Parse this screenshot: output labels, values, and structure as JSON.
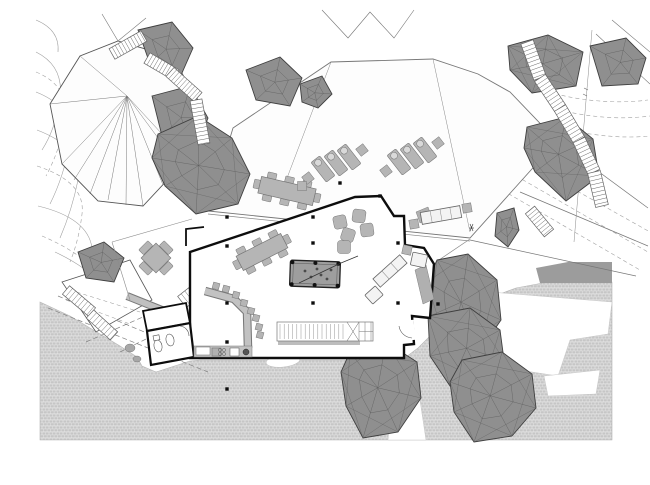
{
  "meta": {
    "drawing_type": "architectural-site-plan",
    "canvas": {
      "width": 650,
      "height": 485,
      "background": "#ffffff"
    }
  },
  "palette": {
    "rockFill": "#8f8f8f",
    "rockEdge": "#3f3f3f",
    "rockMesh": "#565656",
    "furn": "#b5b5b5",
    "furnEdge": "#787878",
    "furnLight": "#f3f3f3",
    "wall": "#0d0d0d",
    "line": "#666666",
    "thin": "#8c8c8c",
    "contour": "#a0a0a0",
    "pavingBg": "#e2e2e2",
    "pavingBrick": "#c6c6c6",
    "pavingDark": "#9c9c9c",
    "pool": "#9e9e9e",
    "white": "#ffffff",
    "offwhite": "#fdfdfd"
  },
  "contours": {
    "solid": [
      "M36,52 Q64,66 60,98 Q56,128 42,150",
      "M36,92 Q76,108 70,142 Q64,176 50,204",
      "M37,130 Q84,148 78,180 Q72,210 60,238",
      "M38,206 Q88,218 92,248 Q95,268 108,284",
      "M55,252 Q85,266 104,286",
      "M36,20 Q60,30 58,52"
    ],
    "dashed": [
      "M36,72 Q70,86 65,120 Q60,150 46,176",
      "M37,166 Q86,182 82,214 Q79,240 70,262",
      "M42,236 Q80,252 98,274",
      "M548,92 Q600,106 648,100",
      "M552,108 Q604,122 650,116",
      "M384,128 Q410,118 434,128",
      "M560,128 Q610,140 650,136",
      "M492,162 L648,252",
      "M504,150 L650,232",
      "M478,176 L640,270"
    ]
  },
  "paving": {
    "main": [
      [
        40,
        302
      ],
      [
        70,
        316
      ],
      [
        120,
        346
      ],
      [
        137,
        357
      ],
      [
        142,
        366
      ],
      [
        156,
        372
      ],
      [
        190,
        361
      ],
      [
        200,
        360
      ],
      [
        336,
        360
      ],
      [
        402,
        360
      ],
      [
        418,
        348
      ],
      [
        436,
        330
      ],
      [
        458,
        314
      ],
      [
        484,
        300
      ],
      [
        516,
        288
      ],
      [
        548,
        282
      ],
      [
        612,
        282
      ],
      [
        612,
        440
      ],
      [
        40,
        440
      ]
    ],
    "cutouts": [
      [
        [
          490,
          292
        ],
        [
          612,
          302
        ],
        [
          608,
          334
        ],
        [
          570,
          340
        ],
        [
          558,
          376
        ],
        [
          506,
          368
        ],
        [
          480,
          328
        ]
      ],
      [
        [
          544,
          376
        ],
        [
          600,
          370
        ],
        [
          596,
          394
        ],
        [
          548,
          396
        ]
      ],
      [
        [
          396,
          362
        ],
        [
          414,
          361
        ],
        [
          426,
          440
        ],
        [
          388,
          440
        ]
      ]
    ],
    "blob": {
      "cx": 283,
      "cy": 361,
      "rx": 17,
      "ry": 6,
      "rot": -6
    },
    "darkBand": [
      [
        536,
        268
      ],
      [
        568,
        262
      ],
      [
        612,
        262
      ],
      [
        612,
        283
      ],
      [
        540,
        283
      ]
    ],
    "dashedDiagonals": [
      "M48,308 L208,372",
      "M58,296 L202,356",
      "M86,342 L168,306",
      "M120,352 L180,322"
    ]
  },
  "terrace": {
    "platform": [
      [
        62,
        282
      ],
      [
        130,
        260
      ],
      [
        152,
        300
      ],
      [
        96,
        332
      ]
    ],
    "dashed": [
      "M70,290 L140,312",
      "M66,300 L130,324"
    ],
    "grayBand": "M127,296 L182,318",
    "blobs": [
      [
        130,
        348,
        5,
        4
      ],
      [
        137,
        359,
        4,
        3
      ]
    ]
  },
  "tent": {
    "outline": [
      [
        50,
        104
      ],
      [
        80,
        56
      ],
      [
        118,
        41
      ],
      [
        173,
        57
      ],
      [
        199,
        104
      ],
      [
        186,
        160
      ],
      [
        143,
        206
      ],
      [
        98,
        201
      ],
      [
        62,
        164
      ]
    ],
    "apex": [
      127,
      96
    ],
    "rayTargets": [
      [
        62,
        164
      ],
      [
        74,
        180
      ],
      [
        90,
        194
      ],
      [
        108,
        200
      ],
      [
        126,
        205
      ],
      [
        143,
        206
      ],
      [
        163,
        185
      ],
      [
        178,
        165
      ],
      [
        186,
        160
      ],
      [
        50,
        104
      ],
      [
        80,
        56
      ]
    ],
    "extraLines": [
      "M118,41 L102,14",
      "M118,41 L146,18",
      "M322,10 L348,38 L370,12 L394,38 L414,10",
      "M612,20 L650,52",
      "M596,34 L650,84"
    ]
  },
  "roof": {
    "outline": [
      [
        233,
        128
      ],
      [
        331,
        62
      ],
      [
        433,
        59
      ],
      [
        478,
        74
      ],
      [
        510,
        92
      ],
      [
        557,
        141
      ],
      [
        470,
        238
      ],
      [
        208,
        211
      ]
    ],
    "folds": [
      "M433,59 L470,232",
      "M331,62 L284,186"
    ],
    "edgeDouble": [
      "M208,214 L470,241",
      "M470,239 L436,262"
    ]
  },
  "walkway": {
    "lines": [
      "M557,141 L648,208",
      "M470,240 L636,276",
      "M520,192 L648,246"
    ],
    "propertyLine": "M592,30 L574,242",
    "ticks": [
      "M584,88 L588,90",
      "M583,94 L587,96"
    ]
  },
  "rocks": [
    {
      "name": "rock-nw-1",
      "pts": [
        [
          138,
          30
        ],
        [
          172,
          22
        ],
        [
          193,
          48
        ],
        [
          178,
          82
        ],
        [
          150,
          64
        ]
      ]
    },
    {
      "name": "rock-nw-2",
      "pts": [
        [
          152,
          96
        ],
        [
          190,
          86
        ],
        [
          208,
          118
        ],
        [
          194,
          152
        ],
        [
          162,
          136
        ]
      ]
    },
    {
      "name": "rock-nw-3",
      "pts": [
        [
          158,
          134
        ],
        [
          198,
          116
        ],
        [
          232,
          138
        ],
        [
          250,
          174
        ],
        [
          238,
          204
        ],
        [
          196,
          214
        ],
        [
          165,
          186
        ],
        [
          152,
          158
        ]
      ]
    },
    {
      "name": "rock-w",
      "pts": [
        [
          78,
          252
        ],
        [
          104,
          242
        ],
        [
          124,
          258
        ],
        [
          114,
          282
        ],
        [
          86,
          278
        ]
      ]
    },
    {
      "name": "rock-n-1",
      "pts": [
        [
          246,
          70
        ],
        [
          280,
          57
        ],
        [
          302,
          78
        ],
        [
          290,
          106
        ],
        [
          256,
          100
        ]
      ]
    },
    {
      "name": "rock-n-2",
      "pts": [
        [
          300,
          84
        ],
        [
          322,
          76
        ],
        [
          332,
          94
        ],
        [
          318,
          108
        ],
        [
          302,
          102
        ]
      ]
    },
    {
      "name": "rock-ne-1",
      "pts": [
        [
          508,
          46
        ],
        [
          548,
          35
        ],
        [
          583,
          52
        ],
        [
          576,
          86
        ],
        [
          532,
          93
        ],
        [
          510,
          70
        ]
      ]
    },
    {
      "name": "rock-ne-2",
      "pts": [
        [
          590,
          46
        ],
        [
          626,
          38
        ],
        [
          646,
          58
        ],
        [
          638,
          84
        ],
        [
          602,
          86
        ]
      ]
    },
    {
      "name": "rock-ne-3",
      "pts": [
        [
          527,
          127
        ],
        [
          566,
          117
        ],
        [
          593,
          139
        ],
        [
          599,
          176
        ],
        [
          566,
          201
        ],
        [
          535,
          172
        ],
        [
          524,
          148
        ]
      ]
    },
    {
      "name": "rock-e",
      "pts": [
        [
          497,
          213
        ],
        [
          514,
          208
        ],
        [
          519,
          230
        ],
        [
          508,
          247
        ],
        [
          495,
          236
        ]
      ]
    },
    {
      "name": "rock-se-upper",
      "pts": [
        [
          437,
          260
        ],
        [
          468,
          254
        ],
        [
          497,
          280
        ],
        [
          501,
          320
        ],
        [
          479,
          352
        ],
        [
          449,
          354
        ],
        [
          430,
          316
        ],
        [
          427,
          282
        ]
      ]
    },
    {
      "name": "rock-se-mid",
      "pts": [
        [
          428,
          316
        ],
        [
          470,
          308
        ],
        [
          500,
          330
        ],
        [
          504,
          360
        ],
        [
          484,
          382
        ],
        [
          450,
          386
        ],
        [
          430,
          356
        ]
      ]
    },
    {
      "name": "rock-se-lower",
      "pts": [
        [
          462,
          360
        ],
        [
          502,
          352
        ],
        [
          532,
          374
        ],
        [
          536,
          408
        ],
        [
          512,
          436
        ],
        [
          474,
          442
        ],
        [
          454,
          412
        ],
        [
          450,
          382
        ]
      ]
    },
    {
      "name": "rock-s",
      "pts": [
        [
          350,
          352
        ],
        [
          386,
          342
        ],
        [
          417,
          362
        ],
        [
          421,
          398
        ],
        [
          398,
          432
        ],
        [
          363,
          438
        ],
        [
          346,
          406
        ],
        [
          341,
          372
        ]
      ]
    }
  ],
  "stairs": [
    {
      "name": "stair-nw-1",
      "a": [
        112,
        54
      ],
      "b": [
        144,
        36
      ],
      "w": 12,
      "s": 3.5
    },
    {
      "name": "stair-nw-2",
      "a": [
        147,
        58
      ],
      "b": [
        176,
        75
      ],
      "w": 12,
      "s": 3.5
    },
    {
      "name": "stair-nw-3",
      "a": [
        170,
        72
      ],
      "b": [
        198,
        97
      ],
      "w": 12,
      "s": 3.5
    },
    {
      "name": "stair-nw-4",
      "a": [
        196,
        100
      ],
      "b": [
        204,
        144
      ],
      "w": 12,
      "s": 4
    },
    {
      "name": "stair-ne-1",
      "a": [
        527,
        42
      ],
      "b": [
        540,
        78
      ],
      "w": 13,
      "s": 4
    },
    {
      "name": "stair-ne-2",
      "a": [
        540,
        78
      ],
      "b": [
        560,
        108
      ],
      "w": 13,
      "s": 4
    },
    {
      "name": "stair-ne-3",
      "a": [
        560,
        108
      ],
      "b": [
        579,
        140
      ],
      "w": 13,
      "s": 4
    },
    {
      "name": "stair-ne-4",
      "a": [
        579,
        140
      ],
      "b": [
        594,
        172
      ],
      "w": 13,
      "s": 4
    },
    {
      "name": "stair-ne-5",
      "a": [
        594,
        172
      ],
      "b": [
        602,
        206
      ],
      "w": 13,
      "s": 4
    },
    {
      "name": "stair-walkway",
      "a": [
        530,
        210
      ],
      "b": [
        549,
        233
      ],
      "w": 12,
      "s": 3.5
    },
    {
      "name": "stair-terrace-1",
      "a": [
        66,
        290
      ],
      "b": [
        92,
        312
      ],
      "w": 11,
      "s": 4
    },
    {
      "name": "stair-terrace-2",
      "a": [
        90,
        314
      ],
      "b": [
        114,
        336
      ],
      "w": 11,
      "s": 4
    },
    {
      "name": "stair-terrace-3",
      "a": [
        182,
        302
      ],
      "b": [
        210,
        280
      ],
      "w": 14,
      "s": 4.5
    }
  ],
  "building": {
    "wall": "M190,252 L310,212 L355,197 L381,196 L394,216 L404,216 L405,245 L424,248 L434,264 L430,318 L412,316 L414,344 L404,345 L404,358 L190,358 Z",
    "stubs": [
      "M186,246 L186,229 L204,227"
    ],
    "deckLines": [
      "M112,242 L192,219",
      "M112,242 L130,300"
    ],
    "wcUpper": [
      [
        143,
        311
      ],
      [
        186,
        303
      ],
      [
        190,
        323
      ],
      [
        147,
        331
      ]
    ],
    "wcLower": [
      [
        147,
        331
      ],
      [
        190,
        323
      ],
      [
        194,
        357
      ],
      [
        151,
        365
      ]
    ],
    "wcDoorArc": "M180,326 A10,10 0 0 1 189,336",
    "doorGap": {
      "x1": 411,
      "y1": 320,
      "x2": 413,
      "y2": 340
    },
    "doorArc": "M412,338 A14,14 0 0 1 399,326"
  },
  "furniture": {
    "tablesLong": [
      {
        "name": "dining-table-outdoor",
        "c": [
          287,
          191
        ],
        "w": 56,
        "h": 17,
        "angle": 13
      },
      {
        "name": "dining-table-indoor",
        "c": [
          262,
          252
        ],
        "w": 50,
        "h": 16,
        "angle": -27
      }
    ],
    "crossTable": {
      "c": [
        156,
        258
      ],
      "size": 21,
      "angle": 45
    },
    "poufs": [
      [
        340,
        222,
        -12
      ],
      [
        359,
        216,
        8
      ],
      [
        348,
        235,
        18
      ],
      [
        367,
        230,
        -8
      ],
      [
        344,
        247,
        0
      ]
    ],
    "loungerGroups": [
      {
        "angle": -38,
        "items": [
          [
            323,
            169
          ],
          [
            336,
            163
          ],
          [
            349,
            157
          ]
        ],
        "tables": [
          [
            308,
            178
          ],
          [
            362,
            150
          ]
        ]
      },
      {
        "angle": -38,
        "items": [
          [
            399,
            162
          ],
          [
            412,
            156
          ],
          [
            425,
            150
          ]
        ],
        "tables": [
          [
            386,
            171
          ],
          [
            438,
            143
          ]
        ]
      }
    ],
    "extraTables": [
      [
        302,
        186
      ]
    ],
    "poolTable": {
      "c": [
        315,
        274
      ],
      "w": 50,
      "h": 26,
      "angle": 2,
      "balls": [
        [
          305,
          271
        ],
        [
          311,
          277
        ],
        [
          317,
          269
        ],
        [
          321,
          275
        ],
        [
          327,
          279
        ],
        [
          331,
          270
        ]
      ],
      "cue": "M299,283 L341,263 L358,256"
    },
    "sofaLong": {
      "c": [
        441,
        215
      ],
      "len": 40,
      "dep": 12,
      "angle": -10,
      "seats": 4,
      "tables": [
        [
          414,
          224
        ],
        [
          467,
          208
        ]
      ]
    },
    "sofaAngled": {
      "c": [
        390,
        271
      ],
      "len": 36,
      "dep": 11,
      "angle": -42,
      "seats": 3
    },
    "armchairs": [
      {
        "c": [
          374,
          295
        ],
        "w": 14,
        "h": 12,
        "angle": -42
      },
      {
        "c": [
          419,
          260
        ],
        "w": 15,
        "h": 13,
        "angle": 12
      }
    ],
    "ottoman": {
      "c": [
        407,
        250
      ],
      "w": 9,
      "h": 9,
      "angle": 12
    },
    "grayQuads": [
      [
        [
          415,
          270
        ],
        [
          426,
          265
        ],
        [
          434,
          299
        ],
        [
          423,
          304
        ]
      ],
      [
        [
          416,
          212
        ],
        [
          428,
          207
        ],
        [
          432,
          218
        ],
        [
          420,
          223
        ]
      ]
    ],
    "bar": {
      "band": "M205,291 L234,299 L247,312 L248,348",
      "stools": [
        [
          216,
          286
        ],
        [
          226,
          289
        ],
        [
          236,
          295
        ],
        [
          244,
          303
        ],
        [
          251,
          311
        ],
        [
          256,
          318
        ],
        [
          259,
          327
        ],
        [
          260,
          335
        ]
      ],
      "stoolSize": 6.5
    },
    "counter": {
      "x": 194,
      "y": 346,
      "w": 58,
      "h": 11,
      "box1": [
        196,
        347,
        14,
        8
      ],
      "box2": [
        212,
        348,
        9,
        8
      ],
      "burners": [
        [
          220,
          350
        ],
        [
          224,
          350
        ],
        [
          220,
          354
        ],
        [
          224,
          354
        ]
      ],
      "sink": [
        230,
        348,
        9,
        8
      ],
      "circle": [
        246,
        352,
        3
      ]
    },
    "shelfStair": {
      "x": 277,
      "y": 322,
      "w": 96,
      "h": 19,
      "step": 4.2,
      "xCell": [
        347,
        359
      ],
      "gridCols": [
        359,
        365,
        371
      ],
      "shadow": [
        278,
        341,
        82,
        4
      ]
    },
    "wcFixtures": [
      [
        158,
        346,
        4,
        6
      ],
      [
        170,
        340,
        4,
        6
      ]
    ],
    "wcSink": [
      153,
      336,
      6,
      5
    ]
  },
  "columns": [
    [
      227,
      217
    ],
    [
      313,
      217
    ],
    [
      340,
      183
    ],
    [
      380,
      196
    ],
    [
      227,
      246
    ],
    [
      313,
      243
    ],
    [
      398,
      243
    ],
    [
      227,
      303
    ],
    [
      313,
      303
    ],
    [
      398,
      303
    ],
    [
      438,
      304
    ],
    [
      227,
      342
    ],
    [
      227,
      389
    ]
  ],
  "figureMark": [
    "M470,224 L473,231",
    "M473,224 L470,231",
    "M469,228 L474,228"
  ]
}
